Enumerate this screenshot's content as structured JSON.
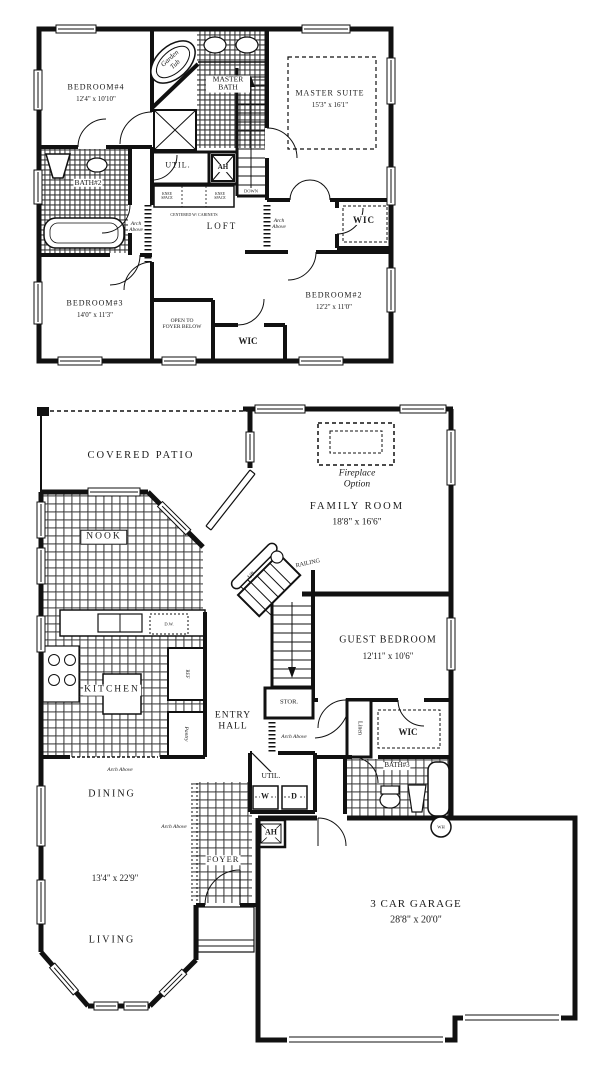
{
  "title": "Two-story house floor plan",
  "colors": {
    "line": "#111111",
    "paper": "#ffffff",
    "text": "#1a1a1a"
  },
  "second_floor": {
    "rooms": {
      "bedroom4": {
        "name": "BEDROOM#4",
        "dims": "12'4\" x 10'10\""
      },
      "garden_tub": {
        "name": "Garden Tub"
      },
      "master_bath": {
        "name": "MASTER BATH"
      },
      "master_suite": {
        "name": "MASTER SUITE",
        "dims": "15'3\" x 16'1\""
      },
      "util": {
        "name": "UTIL."
      },
      "ah": {
        "name": "AH"
      },
      "stairs": {
        "name": "DOWN"
      },
      "bath2": {
        "name": "BATH#2"
      },
      "loft": {
        "name": "LOFT"
      },
      "wic_master": {
        "name": "WIC"
      },
      "bedroom3": {
        "name": "BEDROOM#3",
        "dims": "14'0\" x 11'3\""
      },
      "open_to_foyer": {
        "name": "OPEN TO FOYER BELOW"
      },
      "wic_hall": {
        "name": "WIC"
      },
      "bedroom2": {
        "name": "BEDROOM#2",
        "dims": "12'2\" x 11'0\""
      }
    },
    "annotations": {
      "arch_above_left": "Arch Above",
      "arch_above_right": "Arch Above",
      "knee_space_left": "KNEE SPACE",
      "knee_space_right": "KNEE SPACE",
      "centered_cabinets": "CENTERED W/ CABINETS"
    }
  },
  "first_floor": {
    "rooms": {
      "covered_patio": {
        "name": "COVERED PATIO"
      },
      "fireplace_option": {
        "name": "Fireplace Option"
      },
      "family_room": {
        "name": "FAMILY ROOM",
        "dims": "18'8\" x 16'6\""
      },
      "nook": {
        "name": "NOOK"
      },
      "guest_bedroom": {
        "name": "GUEST BEDROOM",
        "dims": "12'11\" x 10'6\""
      },
      "kitchen": {
        "name": "KITCHEN"
      },
      "entry_hall": {
        "name": "ENTRY HALL"
      },
      "stor": {
        "name": "STOR."
      },
      "linen": {
        "name": "Linen"
      },
      "wic": {
        "name": "WIC"
      },
      "bath3": {
        "name": "BATH#3"
      },
      "util": {
        "name": "UTIL."
      },
      "washer": "W",
      "dryer": "D",
      "ah": "AH",
      "dining": {
        "name": "DINING"
      },
      "foyer": {
        "name": "FOYER"
      },
      "dining_living_dims": "13'4\" x 22'9\"",
      "living": {
        "name": "LIVING"
      },
      "garage": {
        "name": "3 CAR GARAGE",
        "dims": "28'8\" x 20'0\""
      },
      "wh": "WH"
    },
    "annotations": {
      "up": "UP",
      "railing": "RAILING",
      "dw": "D.W.",
      "ref": "REF",
      "pantry": "Pantry",
      "arch_above_entry": "Arch Above",
      "arch_above_kitchen": "Arch Above",
      "arch_above_foyer": "Arch Above"
    }
  }
}
